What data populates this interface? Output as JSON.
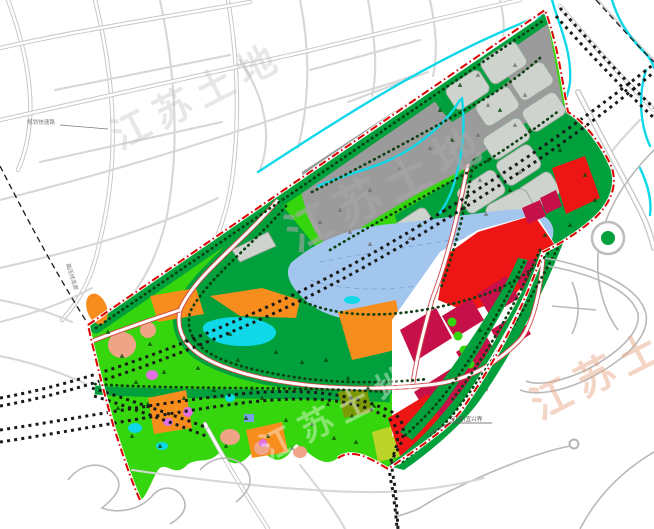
{
  "map": {
    "type": "urban-land-use-planning-map",
    "watermark": {
      "text": "江苏土地"
    },
    "labels": {
      "nw_road": "规划快速路",
      "corridor": "高压线走廊",
      "boundary_se": "至(湖)宜兴界"
    },
    "colors": {
      "road_casing": "#c6c6c6",
      "road_minor": "#d7d7d7",
      "boundary_red": "#dd0000",
      "park_green": "#35d60e",
      "dark_green": "#00a03c",
      "industrial_gray": "#9b9b9b",
      "parcel_gray": "#ced3ce",
      "parcel_stroke": "#93a596",
      "lake_blue": "#a3c6ee",
      "lake_line": "#7fa9d8",
      "stream_cyan": "#0fd8e8",
      "commercial_red": "#ee1515",
      "commercial_crimson": "#c6104a",
      "orange": "#f78d1d",
      "salmon": "#efa387",
      "magenta": "#e070e0",
      "yellow_green": "#bcd32a",
      "olive": "#7c9a08",
      "railway_black": "#1a1a1a",
      "tree_dot": "#0d3f12",
      "internal_road_casing": "#d04848",
      "watermark_gray": "#9e9e9e",
      "watermark_peach": "#e8a27d",
      "label_gray": "#777777"
    }
  }
}
